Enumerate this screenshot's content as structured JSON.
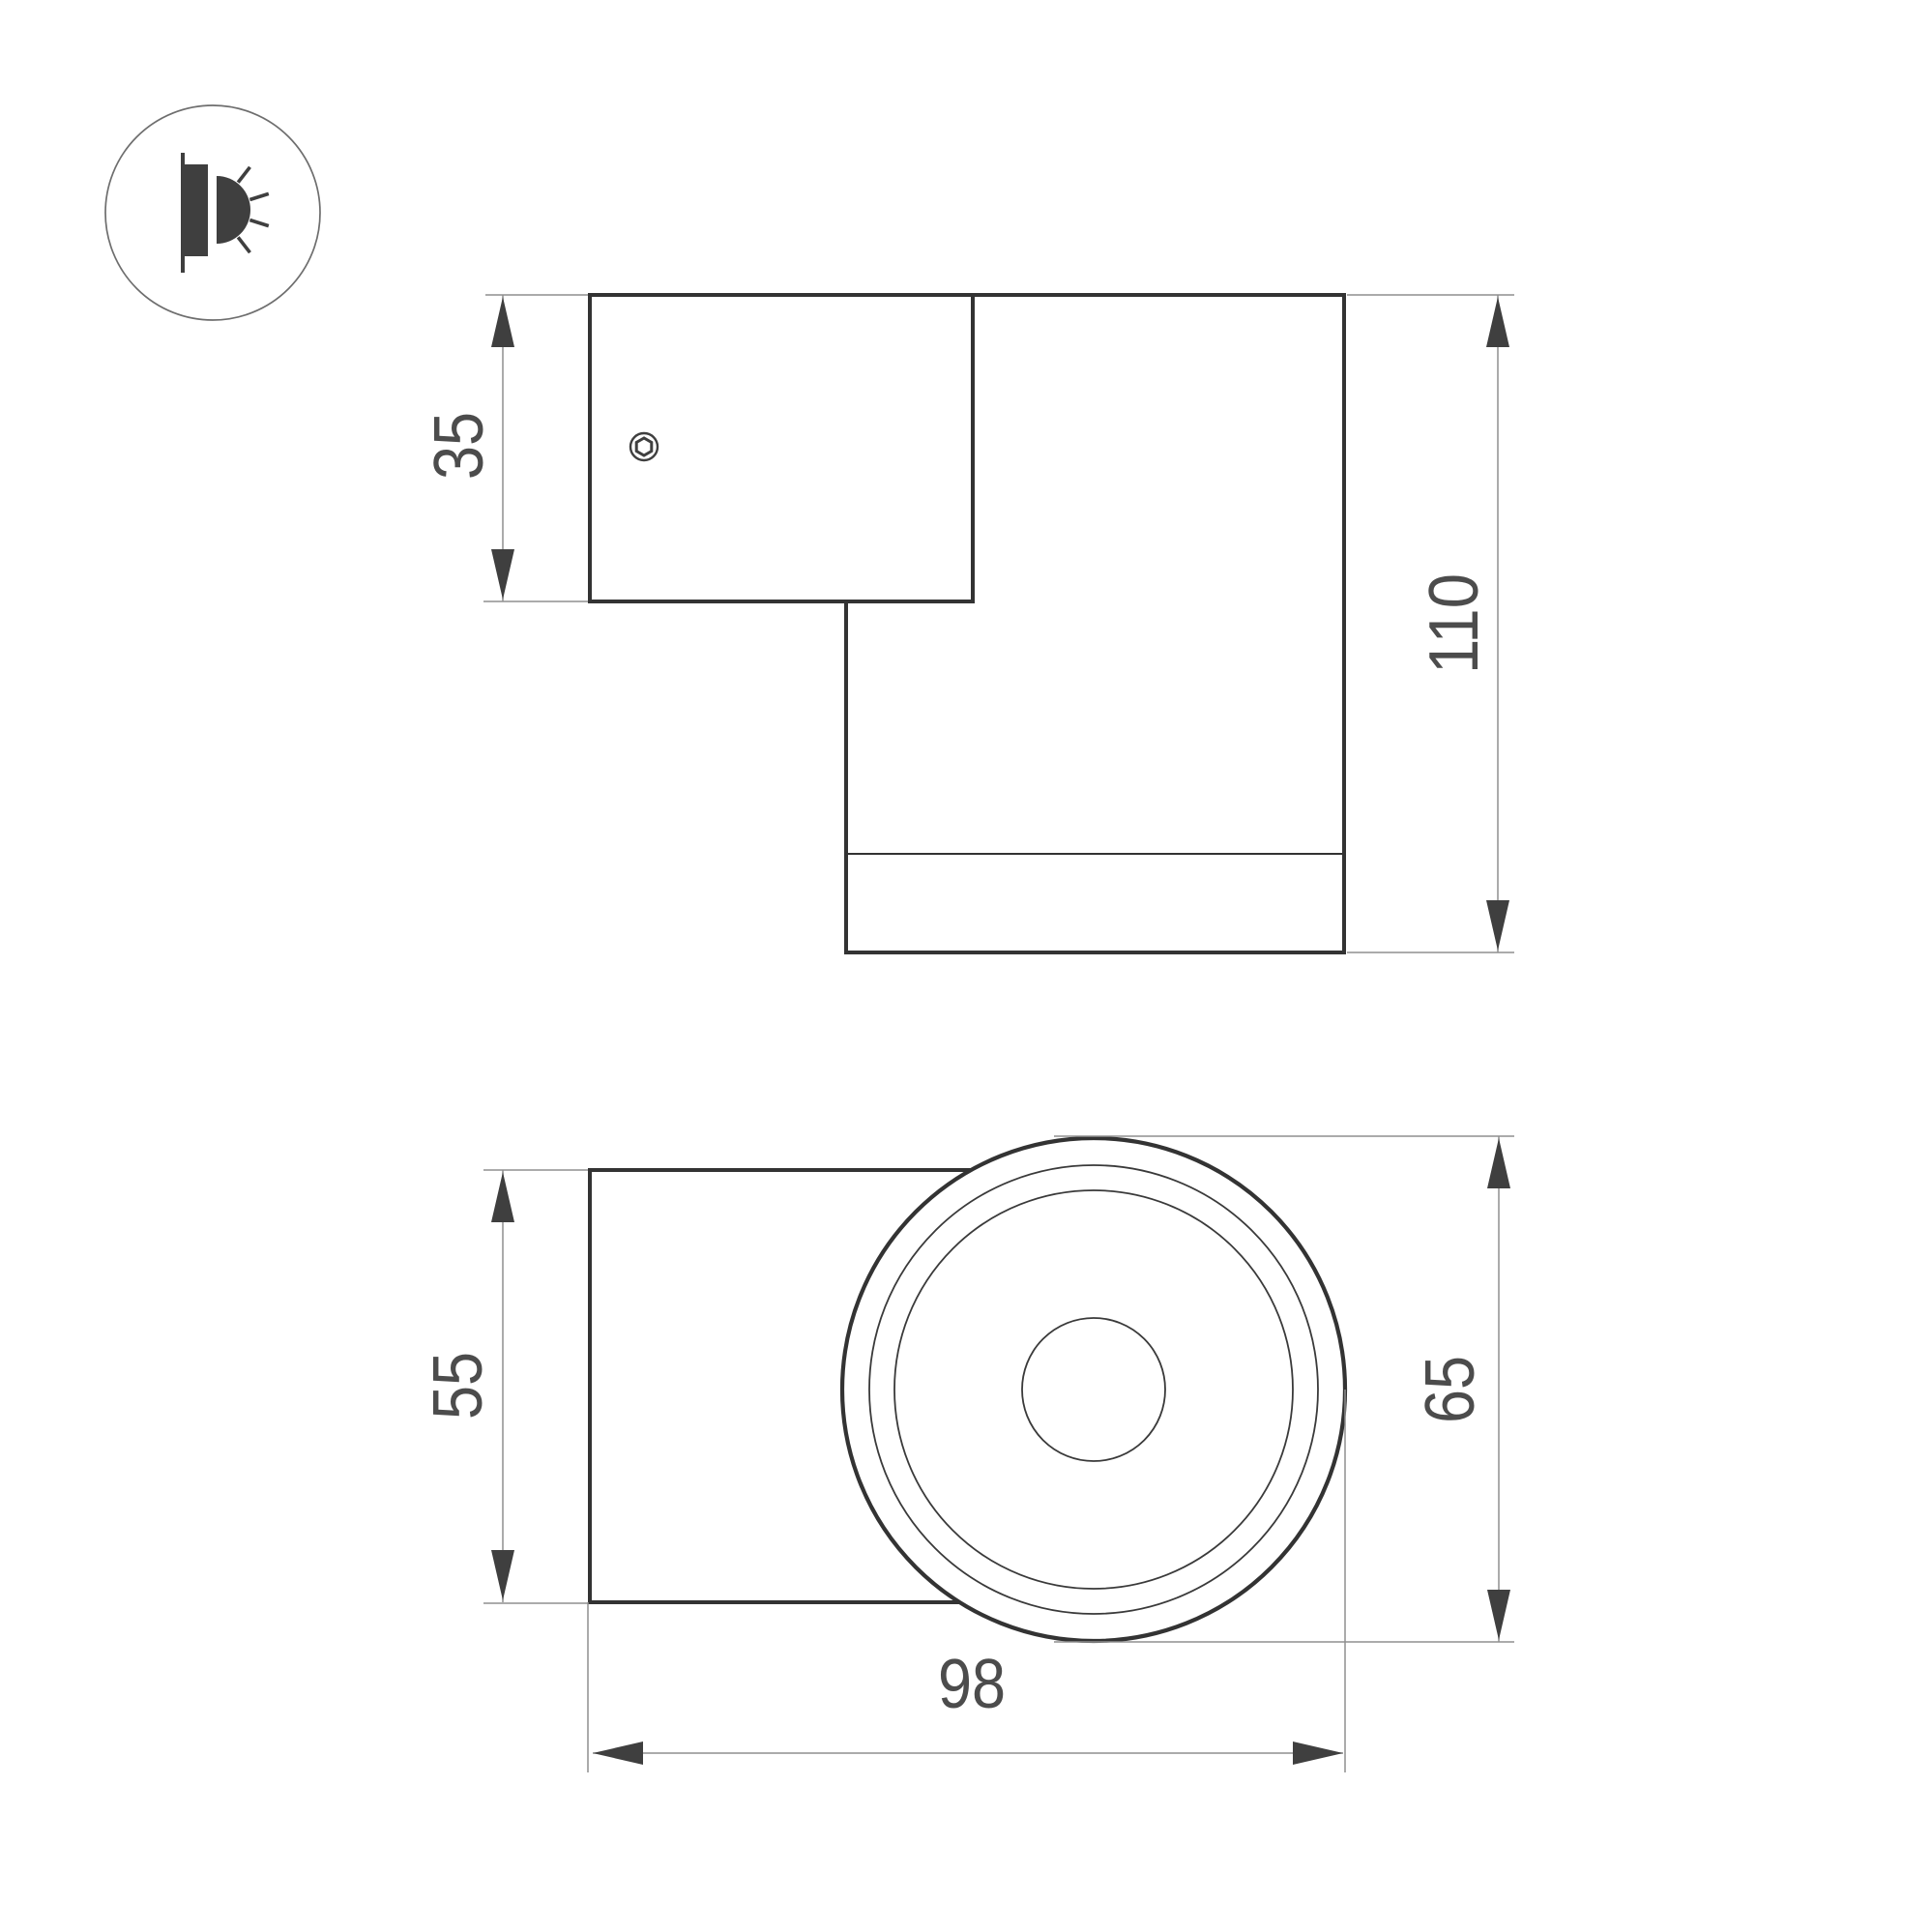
{
  "colors": {
    "background": "#ffffff",
    "outline": "#333333",
    "dimension_line": "#8f8f8f",
    "arrow": "#3f3f3f",
    "label_text": "#4c4c4c",
    "icon": "#3f3f3f"
  },
  "icon": {
    "name": "wall-light-emission-icon"
  },
  "side_view": {
    "dimensions": {
      "plate_height": "35",
      "body_length": "110"
    }
  },
  "front_view": {
    "dimensions": {
      "body_height": "55",
      "head_diameter": "65",
      "overall_width": "98"
    }
  }
}
